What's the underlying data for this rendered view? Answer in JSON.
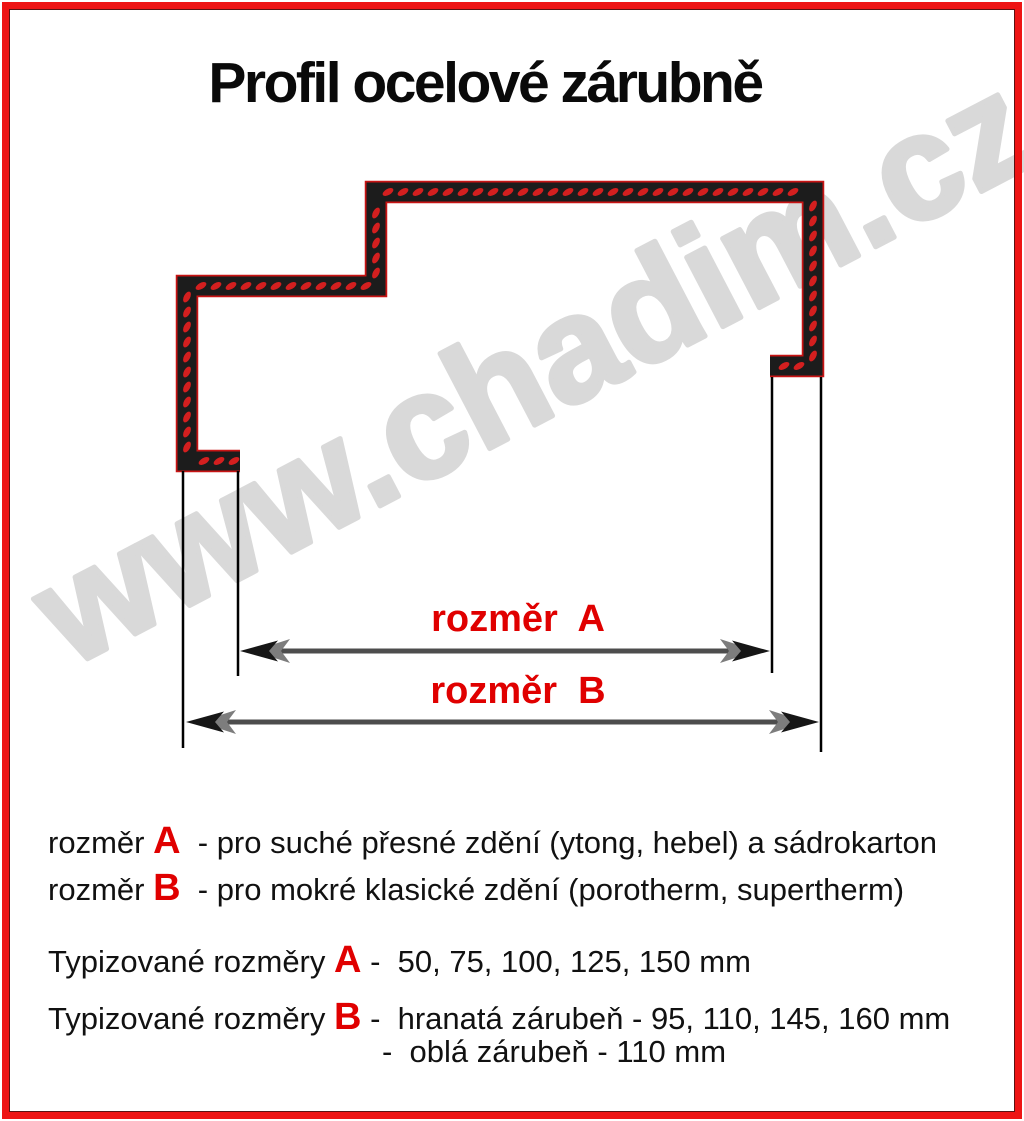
{
  "title": "Profil ocelové zárubně",
  "watermark": "www.chadim.cz",
  "dimension_labels": {
    "a": "rozměr  A",
    "b": "rozměr  B"
  },
  "legend": [
    {
      "prefix": "rozměr ",
      "letter": "A",
      "text": "  - pro suché přesné zdění (ytong, hebel) a sádrokarton"
    },
    {
      "prefix": "rozměr ",
      "letter": "B",
      "text": "  - pro mokré klasické zdění (porotherm, supertherm)"
    }
  ],
  "typified": [
    {
      "prefix": "Typizované rozměry ",
      "letter": "A",
      "text": " -  50, 75, 100, 125, 150 mm"
    },
    {
      "prefix": "Typizované rozměry ",
      "letter": "B",
      "text": " -  hranatá zárubeň - 95, 110, 145, 160 mm"
    },
    {
      "prefix": "",
      "letter": "",
      "text": "-  oblá zárubeň - 110 mm"
    }
  ],
  "colors": {
    "border_red": "#ee1414",
    "frame_inner_line": "#5a1212",
    "accent_red": "#e00000",
    "chain_black": "#1c1c1c",
    "dot_red": "#d41f1f",
    "halo_red": "#c81414",
    "watermark_gray": "#d9d9d9",
    "arrow_dark": "#161616",
    "arrow_gray": "#7d7d7d",
    "shaft_gray": "#4d4d4d",
    "line_black": "#000000"
  }
}
